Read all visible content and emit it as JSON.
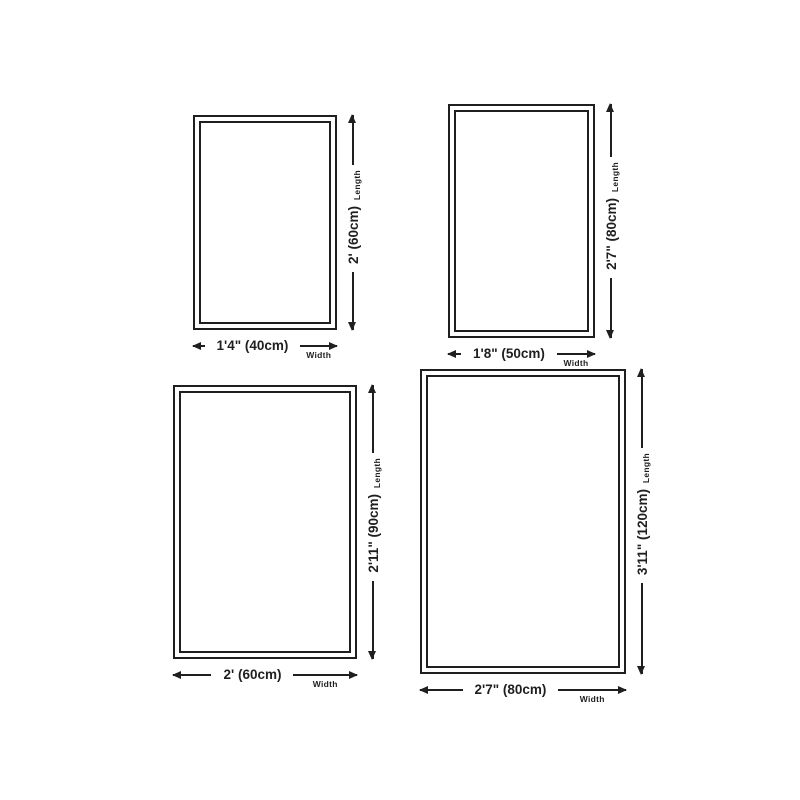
{
  "labels": {
    "length": "Length",
    "width": "Width"
  },
  "rugs": [
    {
      "id": "rug-40x60",
      "length": "2' (60cm)",
      "width": "1'4\" (40cm)"
    },
    {
      "id": "rug-50x80",
      "length": "2'7\" (80cm)",
      "width": "1'8\" (50cm)"
    },
    {
      "id": "rug-60x90",
      "length": "2'11\" (90cm)",
      "width": "2' (60cm)"
    },
    {
      "id": "rug-80x120",
      "length": "3'11\" (120cm)",
      "width": "2'7\" (80cm)"
    }
  ],
  "colors": {
    "line": "#1f1f1f",
    "background": "#ffffff"
  }
}
